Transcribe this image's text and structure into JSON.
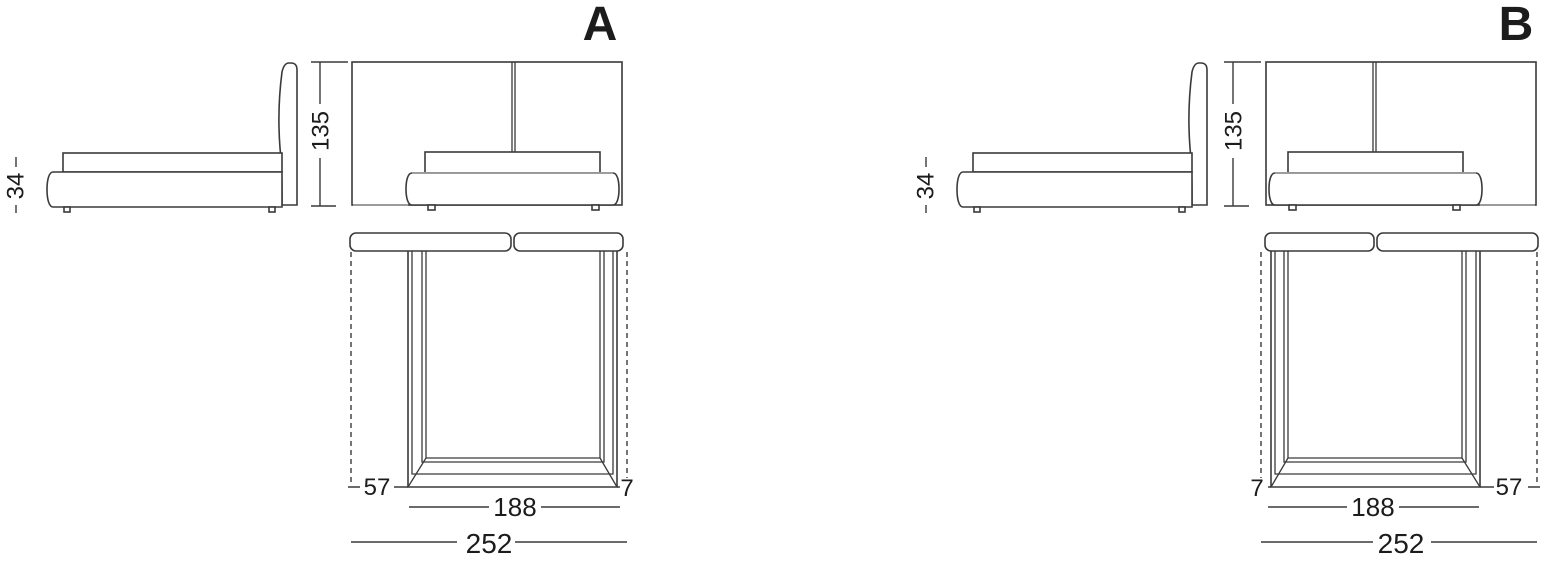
{
  "page": {
    "background": "#ffffff",
    "line_color": "#3a3a3a",
    "gray_line_color": "#9e9e9e",
    "text_color": "#1c1c1c",
    "unit_system": "cm"
  },
  "versions": [
    {
      "label": "A",
      "dimensions": {
        "base_height": "34",
        "headboard_height": "135",
        "outer_left": "57",
        "outer_right": "7",
        "bed_width": "188",
        "total_width": "252"
      }
    },
    {
      "label": "B",
      "dimensions": {
        "base_height": "34",
        "headboard_height": "135",
        "outer_left": "7",
        "outer_right": "57",
        "bed_width": "188",
        "total_width": "252"
      }
    }
  ]
}
